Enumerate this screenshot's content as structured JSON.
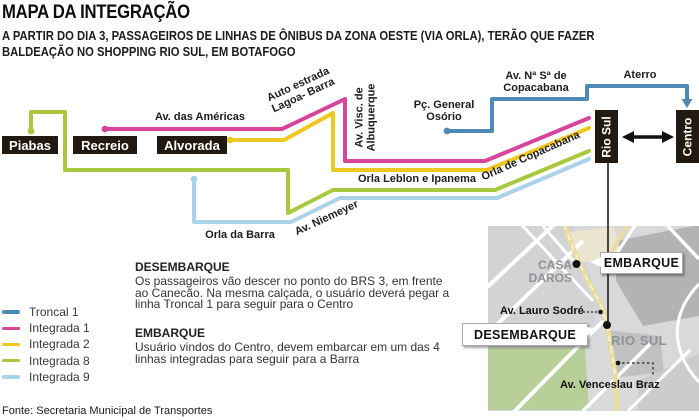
{
  "header": {
    "title": "MAPA DA INTEGRAÇÃO",
    "subtitle_lines": [
      "A PARTIR DO DIA 3, PASSAGEIROS DE LINHAS DE ÔNIBUS DA ZONA OESTE (VIA ORLA), TERÃO QUE FAZER",
      "BALDEAÇÃO NO SHOPPING RIO SUL, EM BOTAFOGO"
    ]
  },
  "diagram": {
    "stations": {
      "piabas": "Piabas",
      "recreio": "Recreio",
      "alvorada": "Alvorada",
      "rio_sul": "Rio Sul",
      "centro": "Centro"
    },
    "roads": {
      "av_das_americas": "Av. das Américas",
      "auto_estrada_line1": "Auto estrada",
      "auto_estrada_line2": "Lagoa- Barra",
      "av_visc_line1": "Av. Visc. de",
      "av_visc_line2": "Albuquerque",
      "pc_general_line1": "Pç. General",
      "pc_general_line2": "Osório",
      "av_ns_line1": "Av. Nª Sª de",
      "av_ns_line2": "Copacabana",
      "aterro": "Aterro",
      "orla_leblon": "Orla Leblon e Ipanema",
      "orla_copacabana": "Orla de Copacabana",
      "orla_barra": "Orla da Barra",
      "av_niemeyer": "Av. Niemeyer"
    }
  },
  "legend": {
    "items": [
      {
        "key": "troncal1",
        "label": "Troncal 1",
        "color": "#4e8ab6"
      },
      {
        "key": "integrada1",
        "label": "Integrada 1",
        "color": "#d6449b"
      },
      {
        "key": "integrada2",
        "label": "Integrada 2",
        "color": "#eec71f"
      },
      {
        "key": "integrada8",
        "label": "Integrada 8",
        "color": "#a9c83d"
      },
      {
        "key": "integrada9",
        "label": "Integrada 9",
        "color": "#a9d3eb"
      }
    ]
  },
  "notes": {
    "desembarque_title": "DESEMBARQUE",
    "desembarque_lines": [
      "Os passageiros vão descer no ponto do BRS 3, em frente",
      "ao Canecão. Na mesma calçada, o usuário deverá pegar a",
      "linha Troncal 1 para seguir para o Centro"
    ],
    "embarque_title": "EMBARQUE",
    "embarque_lines": [
      "Usuário vindos do Centro, devem embarcar em um das 4",
      "linhas integradas para seguir para a Barra"
    ]
  },
  "inset": {
    "casa_daros_line1": "CASA",
    "casa_daros_line2": "DAROS",
    "embarque_callout": "EMBARQUE",
    "desembarque_callout": "DESEMBARQUE",
    "av_lauro_sodre": "Av. Lauro Sodré",
    "rio_sul_area": "RIO SUL",
    "av_venceslau_braz": "Av. Venceslau Braz"
  },
  "footer": {
    "source": "Fonte: Secretaria Municipal de Transportes"
  }
}
